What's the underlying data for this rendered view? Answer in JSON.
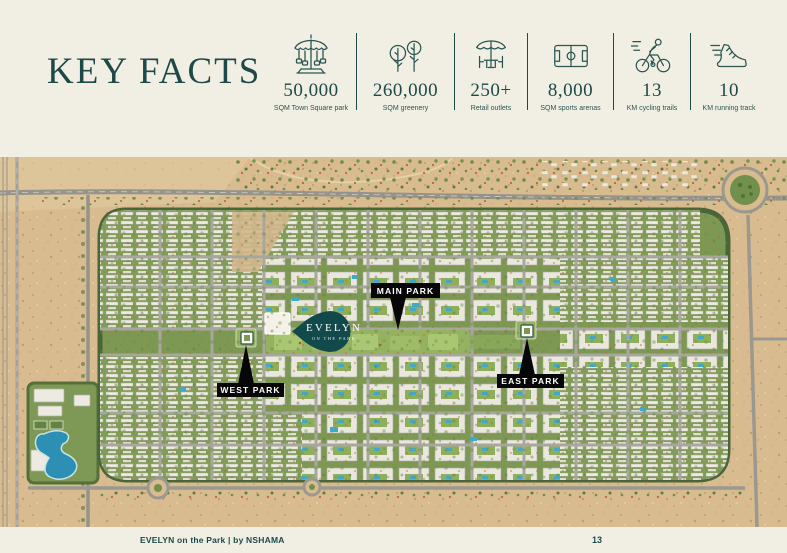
{
  "page": {
    "colors": {
      "background": "#f1efe3",
      "accent": "#1d4a48",
      "label_bg": "#070707",
      "pin_bg": "#12494b",
      "sand": "#d8bc90",
      "greenery": "#7c9853",
      "lagoon": "#2e8fb4"
    }
  },
  "header": {
    "title": "KEY FACTS"
  },
  "stats": [
    {
      "icon": "carousel-icon",
      "value": "50,000",
      "label": "SQM Town Square park"
    },
    {
      "icon": "trees-icon",
      "value": "260,000",
      "label": "SQM greenery"
    },
    {
      "icon": "market-stall-icon",
      "value": "250+",
      "label": "Retail outlets"
    },
    {
      "icon": "sports-field-icon",
      "value": "8,000",
      "label": "SQM sports arenas"
    },
    {
      "icon": "cyclist-icon",
      "value": "13",
      "label": "KM cycling trails"
    },
    {
      "icon": "running-shoe-icon",
      "value": "10",
      "label": "KM running track"
    }
  ],
  "map": {
    "description": "Aerial masterplan render of a desert community development",
    "labels": {
      "main_park": "MAIN PARK",
      "west_park": "WEST PARK",
      "east_park": "EAST PARK"
    },
    "pin": {
      "name": "EVELYN",
      "tagline": "ON THE PARK"
    }
  },
  "footer": {
    "text": "EVELYN on the Park | by NSHAMA",
    "page_number": "13"
  }
}
